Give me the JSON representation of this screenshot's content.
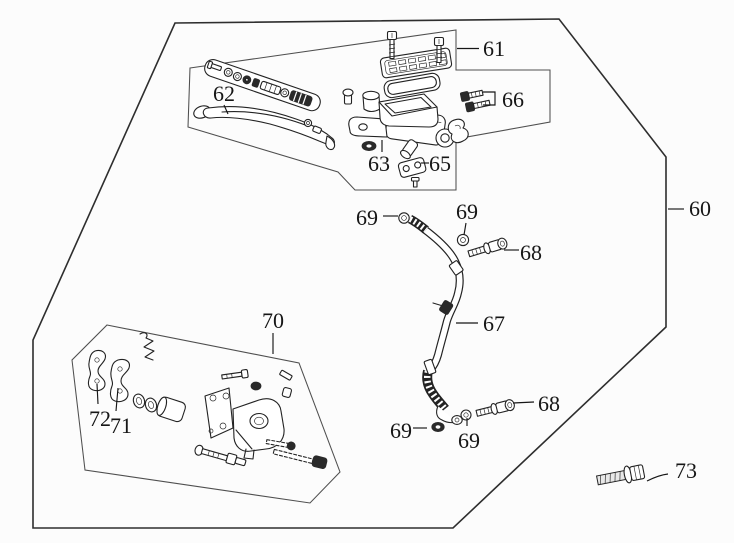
{
  "diagram_type": "exploded-parts-diagram",
  "colors": {
    "ink": "#232323",
    "boundary": "#2e2e2e",
    "inner_box": "#4f4f4f",
    "background": "#fcfcfc"
  },
  "labels": [
    {
      "id": "60",
      "text": "60"
    },
    {
      "id": "61",
      "text": "61"
    },
    {
      "id": "62",
      "text": "62"
    },
    {
      "id": "63",
      "text": "63"
    },
    {
      "id": "65",
      "text": "65"
    },
    {
      "id": "66",
      "text": "66"
    },
    {
      "id": "67",
      "text": "67"
    },
    {
      "id": "68-upper",
      "text": "68"
    },
    {
      "id": "68-lower",
      "text": "68"
    },
    {
      "id": "69-top-left",
      "text": "69"
    },
    {
      "id": "69-top-right",
      "text": "69"
    },
    {
      "id": "69-bottom-left",
      "text": "69"
    },
    {
      "id": "69-bottom-center",
      "text": "69"
    },
    {
      "id": "70",
      "text": "70"
    },
    {
      "id": "71",
      "text": "71"
    },
    {
      "id": "72",
      "text": "72"
    },
    {
      "id": "73",
      "text": "73"
    }
  ]
}
